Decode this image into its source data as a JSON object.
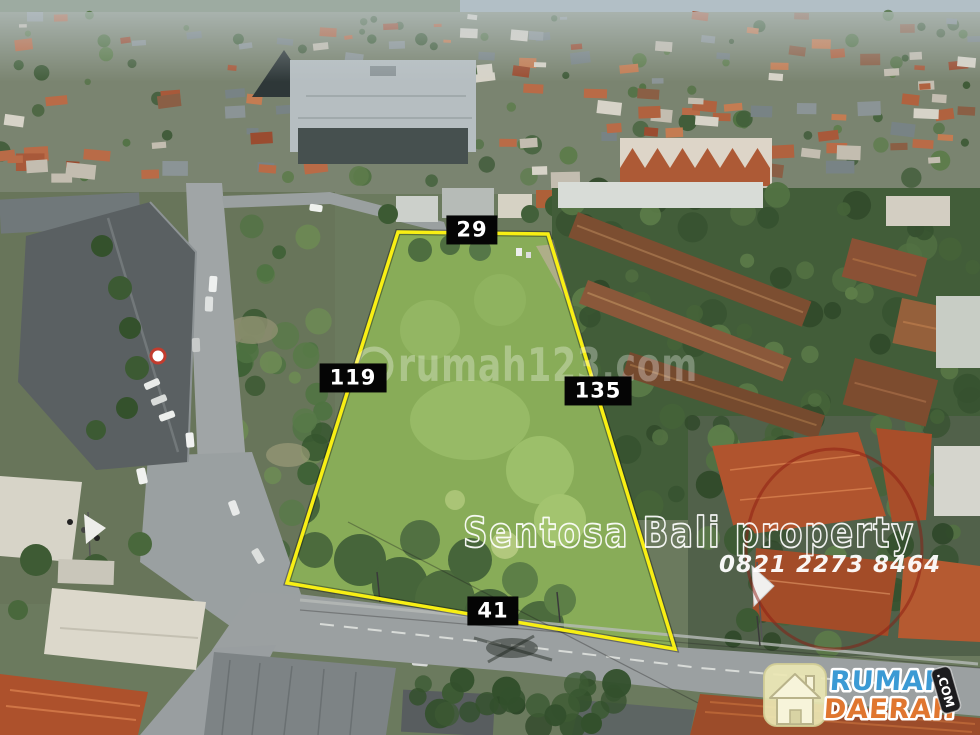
{
  "photo": {
    "description": "Aerial drone view of a vacant grass land plot for sale surrounded by roads, shophouses and villa roofs in Bali"
  },
  "boundary": {
    "stroke_color": "#f8ef14",
    "points": "398,232 548,234 675,649 287,583",
    "label_bg": "#050505",
    "label_text_color": "#ffffff",
    "labels": {
      "top": "29",
      "left": "119",
      "right": "135",
      "bottom": "41"
    }
  },
  "watermark": {
    "portal_text": "rumah123.com",
    "portal_color": "rgba(255,255,255,0.32)",
    "agency_name": "Sentosa Bali property",
    "agency_phone": "0821 2273 8464",
    "agency_text_color": "#ffffff",
    "stamp_circle_color": "rgba(140,25,15,0.5)"
  },
  "brand": {
    "word1": "RUMAH",
    "word2": "DAERAH",
    "badge": ".COM",
    "word1_color": "#3b9ad4",
    "word2_color": "#e0762f",
    "badge_bg": "#1c1c1e",
    "icon": "home-icon"
  }
}
